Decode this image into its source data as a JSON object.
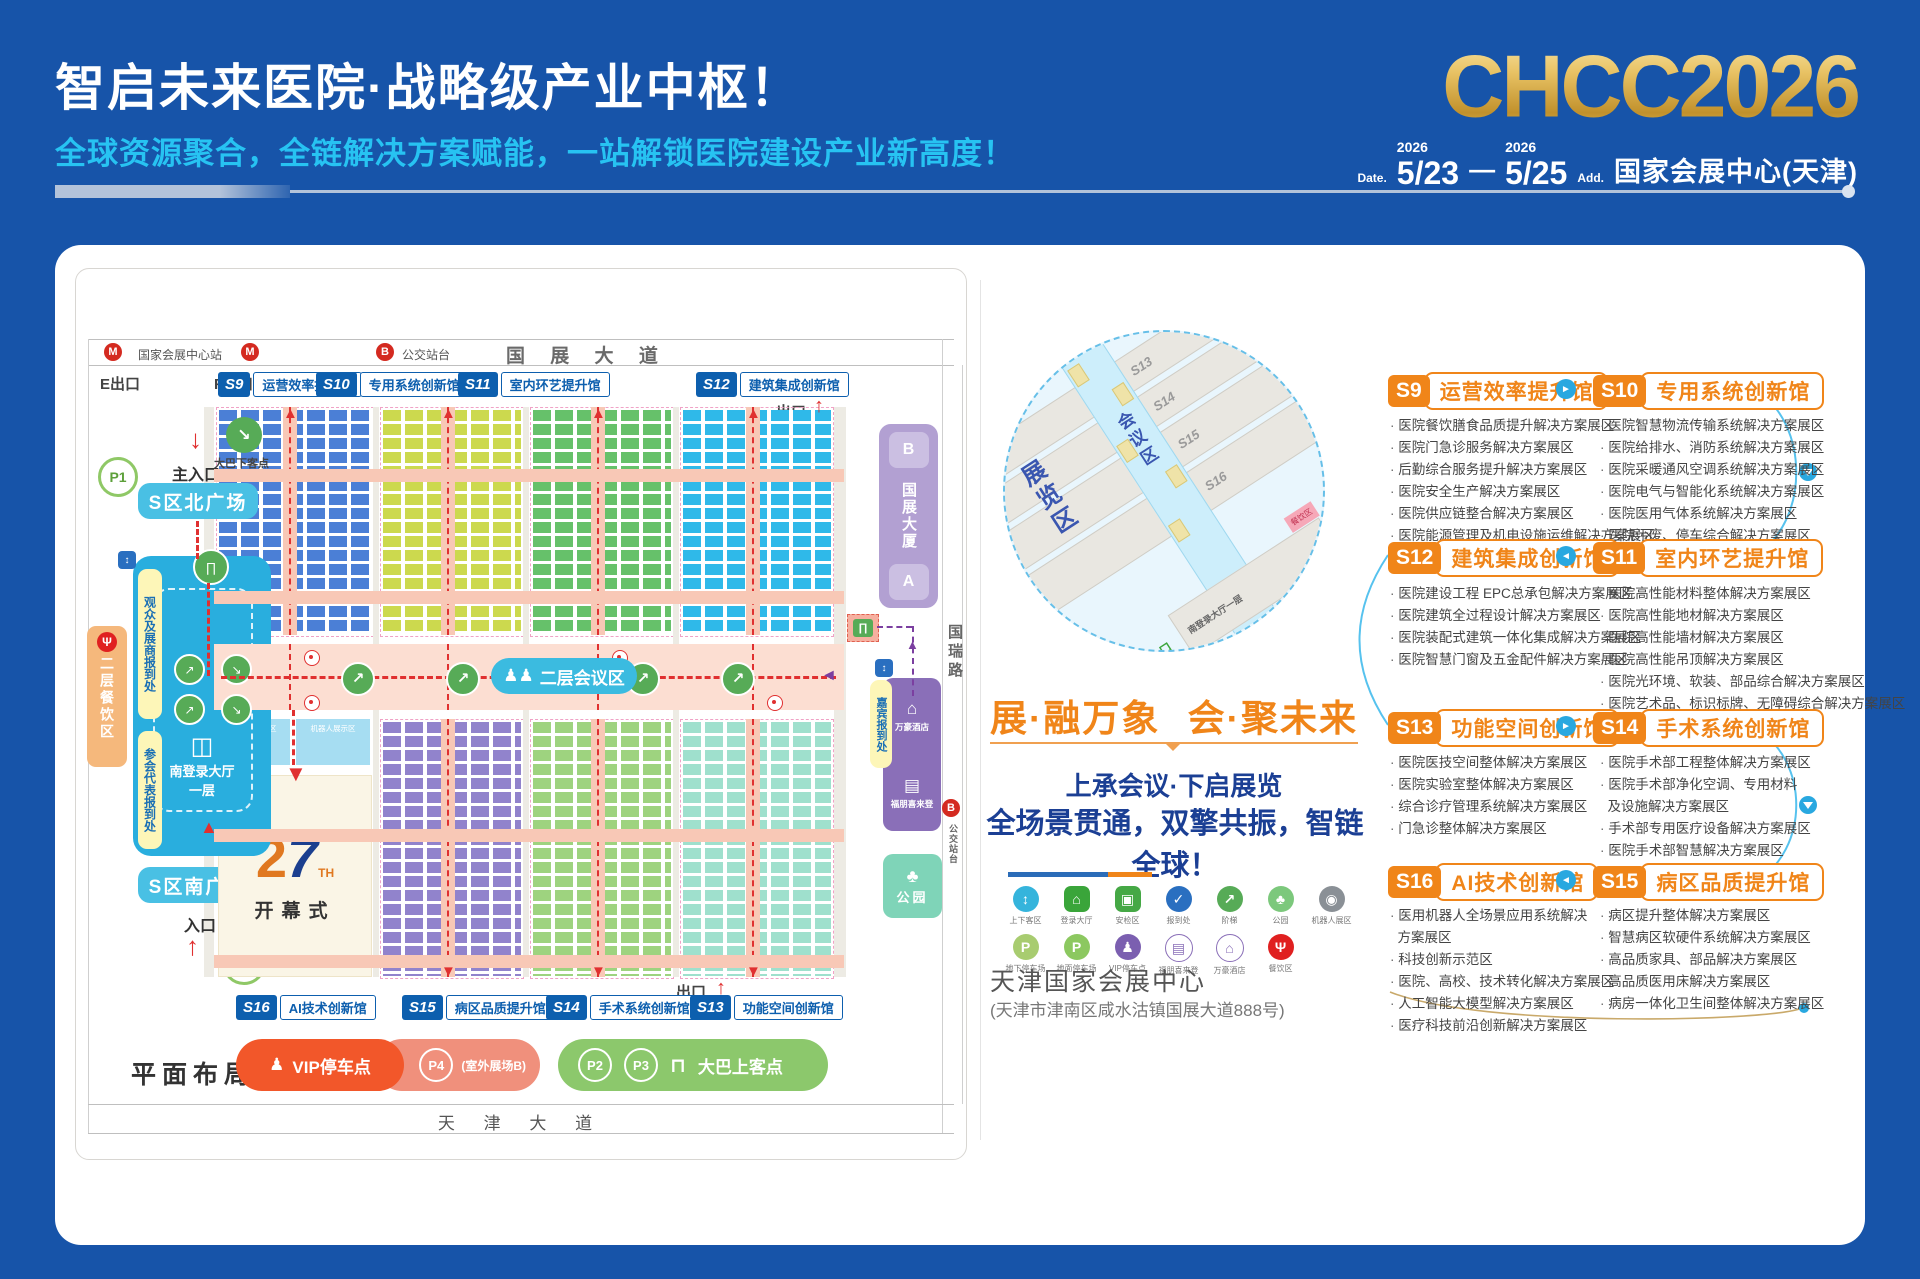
{
  "header": {
    "title": "智启未来医院·战略级产业中枢！",
    "subtitle": "全球资源聚合，全链解决方案赋能，一站解锁医院建设产业新高度！",
    "logo": "CHCC2026",
    "date_label": "Date.",
    "year_from": "2026",
    "date_from": "5/23",
    "dash": "—",
    "year_to": "2026",
    "date_to": "5/25",
    "addr_label": "Add.",
    "venue": "国家会展中心(天津)"
  },
  "map": {
    "station": "国家会展中心站",
    "bus_stop": "公交站台",
    "road_top": "国 展 大 道",
    "exit_e": "E出口",
    "exit_f": "F出口",
    "exit": "出口",
    "halls_top": [
      {
        "id": "S9",
        "name": "运营效率提升馆"
      },
      {
        "id": "S10",
        "name": "专用系统创新馆"
      },
      {
        "id": "S11",
        "name": "室内环艺提升馆"
      },
      {
        "id": "S12",
        "name": "建筑集成创新馆"
      }
    ],
    "halls_bottom": [
      {
        "id": "S16",
        "name": "AI技术创新馆"
      },
      {
        "id": "S15",
        "name": "病区品质提升馆"
      },
      {
        "id": "S14",
        "name": "手术系统创新馆"
      },
      {
        "id": "S13",
        "name": "功能空间创新馆"
      }
    ],
    "left": {
      "bus_drop": "大巴下客点",
      "main_entrance": "主入口",
      "p1": "P1",
      "north_plaza": "S区北广场",
      "reg_visitor": "观众及展商报到处",
      "reg_delegate": "参会代表报到处",
      "dining": "二层餐饮区",
      "hall_name": "南登录大厅",
      "hall_floor": "一层",
      "south_plaza": "S区南广场",
      "entrance": "入口"
    },
    "right": {
      "b": "B",
      "tower": "国展大厦",
      "a": "A",
      "guest_reg": "嘉宾报到处",
      "hotel_marriott": "万豪酒店",
      "hotel_fourpoints": "福朋喜来登",
      "park": "公园",
      "road_right": "国瑞路",
      "bus_stop": "公交站台"
    },
    "conference_pill": "二层会议区",
    "opening": {
      "num2": "2",
      "num7": "7",
      "th": "TH",
      "label": "开幕式",
      "robot": "机器人展示区"
    },
    "legend": {
      "vip": "VIP停车点",
      "p4": "P4",
      "p4_note": "(室外展场B)",
      "p2": "P2",
      "p3": "P3",
      "bus_board": "大巴上客点"
    },
    "plan_label": "平面布局图",
    "road_bottom": "天 津 大 道"
  },
  "middle": {
    "slogan_left": "展·融万象",
    "slogan_right": "会·聚未来",
    "line1": "上承会议·下启展览",
    "line2": "全场景贯通，双擎共振，智链全球！",
    "circle": {
      "zone_exhibit": "展览区",
      "zone_conf": "会议区",
      "halls_left": [
        "S12",
        "S11",
        "S10",
        "S9"
      ],
      "halls_right": [
        "S13",
        "S14",
        "S15",
        "S16"
      ],
      "hall_lower": "南登录大厅一层",
      "entrance": "主入口",
      "dining": "餐饮区"
    },
    "legend_row1": [
      {
        "g": "↕",
        "label": "上下客区"
      },
      {
        "g": "⌂",
        "label": "登录大厅"
      },
      {
        "g": "▣",
        "label": "安检区"
      },
      {
        "g": "✓",
        "label": "报到处"
      },
      {
        "g": "↗",
        "label": "阶梯"
      },
      {
        "g": "♣",
        "label": "公园"
      },
      {
        "g": "◉",
        "label": "机器人展区"
      }
    ],
    "legend_row2": [
      {
        "g": "P",
        "label": "地下停车场"
      },
      {
        "g": "P",
        "label": "地面停车场"
      },
      {
        "g": "♟",
        "label": "VIP停车点"
      },
      {
        "g": "▤",
        "label": "福朋喜来登"
      },
      {
        "g": "⌂",
        "label": "万豪酒店"
      },
      {
        "g": "Ψ",
        "label": "餐饮区"
      }
    ],
    "venue_name": "天津国家会展中心",
    "venue_addr": "(天津市津南区咸水沽镇国展大道888号)"
  },
  "halls": {
    "rows": [
      {
        "dir": "►",
        "left": {
          "id": "S9",
          "name": "运营效率提升馆",
          "items": [
            "医院餐饮膳食品质提升解决方案展区",
            "医院门急诊服务解决方案展区",
            "后勤综合服务提升解决方案展区",
            "医院安全生产解决方案展区",
            "医院供应链整合解决方案展区",
            "医院能源管理及机电设施运维解决方案展区"
          ]
        },
        "right": {
          "id": "S10",
          "name": "专用系统创新馆",
          "items": [
            "医院智慧物流传输系统解决方案展区",
            "医院给排水、消防系统解决方案展区",
            "医院采暖通风空调系统解决方案展区",
            "医院电气与智能化系统解决方案展区",
            "医院医用气体系统解决方案展区",
            "医院污废、停车综合解决方案展区"
          ]
        }
      },
      {
        "dir": "◄",
        "left": {
          "id": "S12",
          "name": "建筑集成创新馆",
          "items": [
            "医院建设工程 EPC总承包解决方案展区",
            "医院建筑全过程设计解决方案展区",
            "医院装配式建筑一体化集成解决方案展区",
            "医院智慧门窗及五金配件解决方案展区"
          ]
        },
        "right": {
          "id": "S11",
          "name": "室内环艺提升馆",
          "items": [
            "医院高性能材料整体解决方案展区",
            "医院高性能地材解决方案展区",
            "医院高性能墙材解决方案展区",
            "医院高性能吊顶解决方案展区",
            "医院光环境、软装、部品综合解决方案展区",
            "医院艺术品、标识标牌、无障碍综合解决方案展区"
          ]
        }
      },
      {
        "dir": "►",
        "left": {
          "id": "S13",
          "name": "功能空间创新馆",
          "items": [
            "医院医技空间整体解决方案展区",
            "医院实验室整体解决方案展区",
            "综合诊疗管理系统解决方案展区",
            "门急诊整体解决方案展区"
          ]
        },
        "right": {
          "id": "S14",
          "name": "手术系统创新馆",
          "items": [
            "医院手术部工程整体解决方案展区",
            "医院手术部净化空调、专用材料\n  及设施解决方案展区",
            "手术部专用医疗设备解决方案展区",
            "医院手术部智慧解决方案展区"
          ]
        }
      },
      {
        "dir": "◄",
        "left": {
          "id": "S16",
          "name": "AI技术创新馆",
          "items": [
            "医用机器人全场景应用系统解决\n  方案展区",
            "科技创新示范区",
            "医院、高校、技术转化解决方案展区",
            "人工智能大模型解决方案展区",
            "医疗科技前沿创新解决方案展区"
          ]
        },
        "right": {
          "id": "S15",
          "name": "病区品质提升馆",
          "items": [
            "病区提升整体解决方案展区",
            "智慧病区软硬件系统解决方案展区",
            "高品质家具、部品解决方案展区",
            "高品质医用床解决方案展区",
            "病房一体化卫生间整体解决方案展区"
          ]
        }
      }
    ]
  }
}
